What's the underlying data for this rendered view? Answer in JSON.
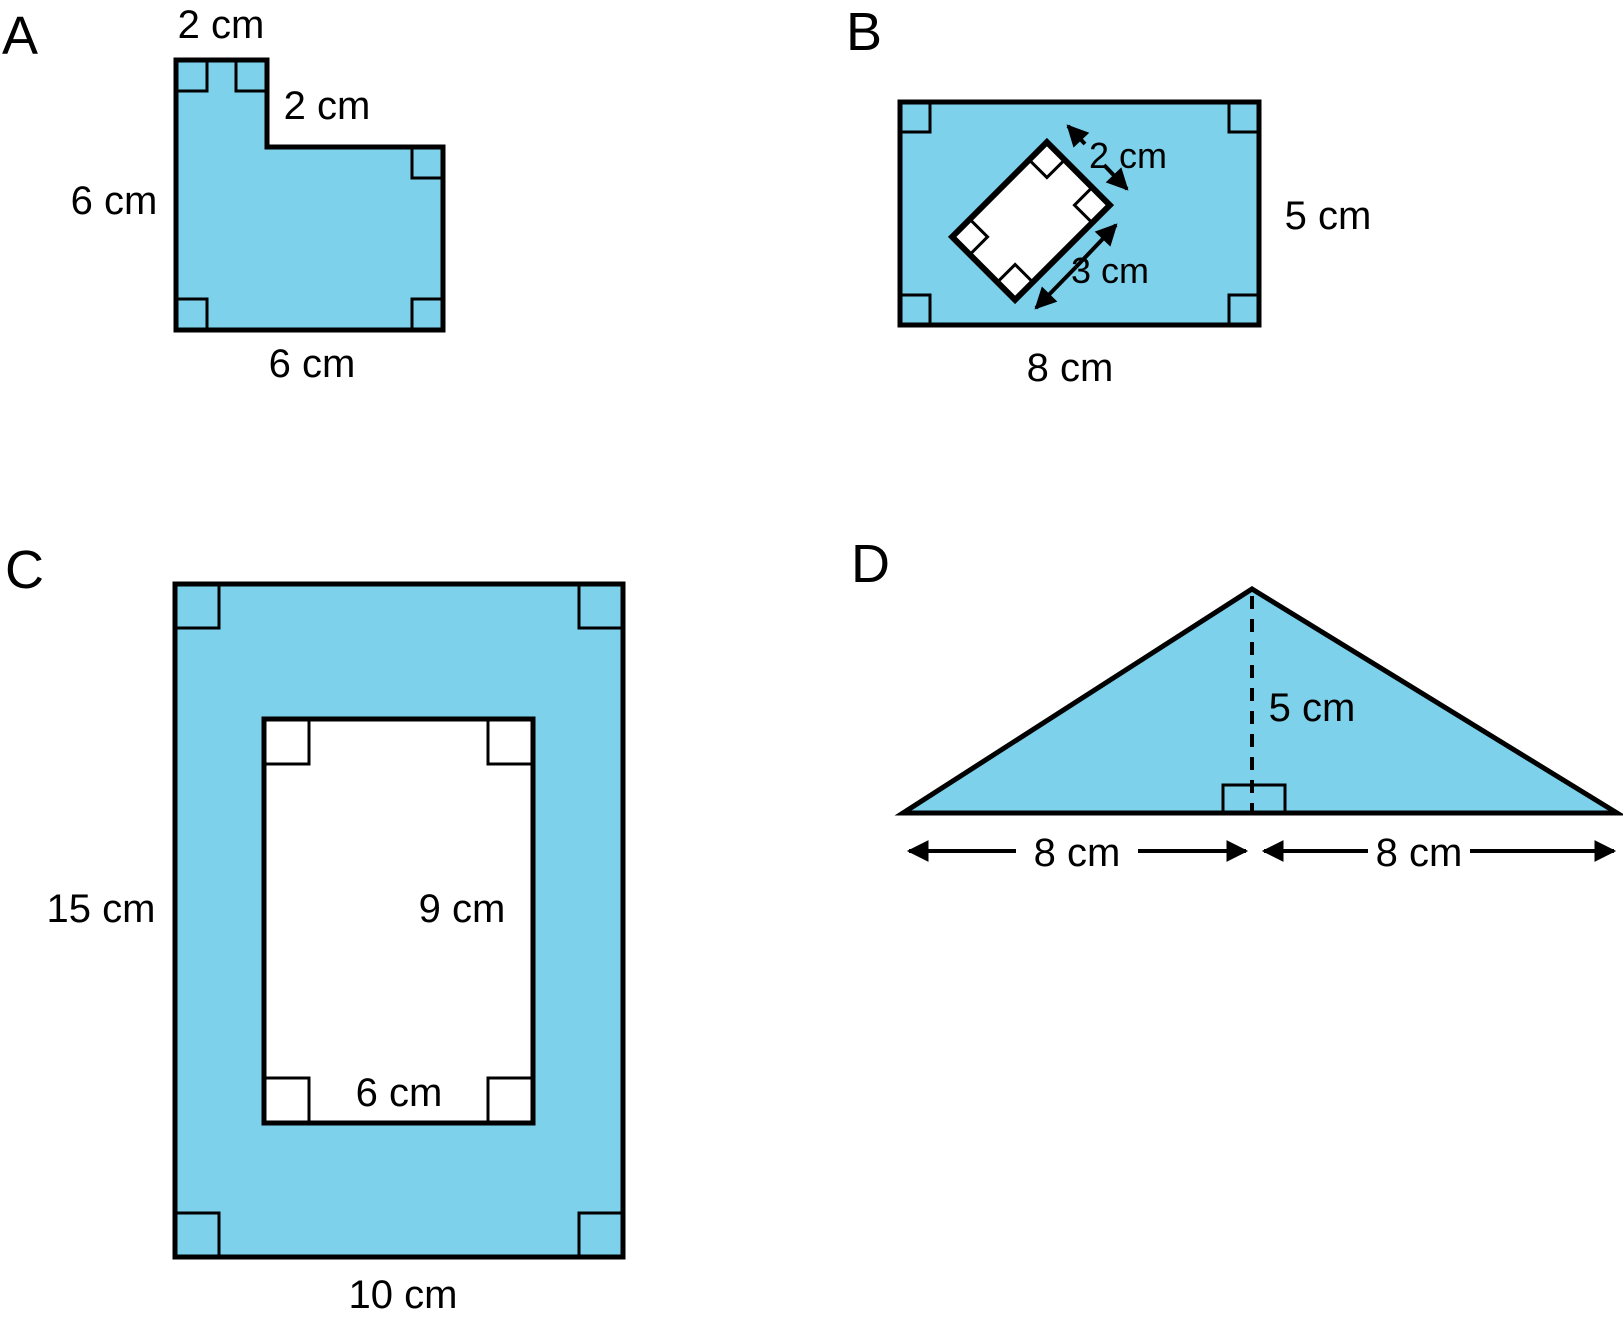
{
  "colors": {
    "shape_fill": "#7DD1EB",
    "outline": "#000000",
    "text": "#000000",
    "background": "#FFFFFF"
  },
  "figures": {
    "a": {
      "letter": "A",
      "top_label": "2 cm",
      "notch_label": "2 cm",
      "left_label": "6 cm",
      "bottom_label": "6 cm"
    },
    "b": {
      "letter": "B",
      "cutout_short_label": "2 cm",
      "cutout_long_label": "3 cm",
      "right_label": "5 cm",
      "bottom_label": "8 cm"
    },
    "c": {
      "letter": "C",
      "left_label": "15 cm",
      "hole_right_label": "9 cm",
      "hole_bottom_label": "6 cm",
      "bottom_label": "10 cm"
    },
    "d": {
      "letter": "D",
      "height_label": "5 cm",
      "base_left_label": "8 cm",
      "base_right_label": "8 cm"
    }
  }
}
